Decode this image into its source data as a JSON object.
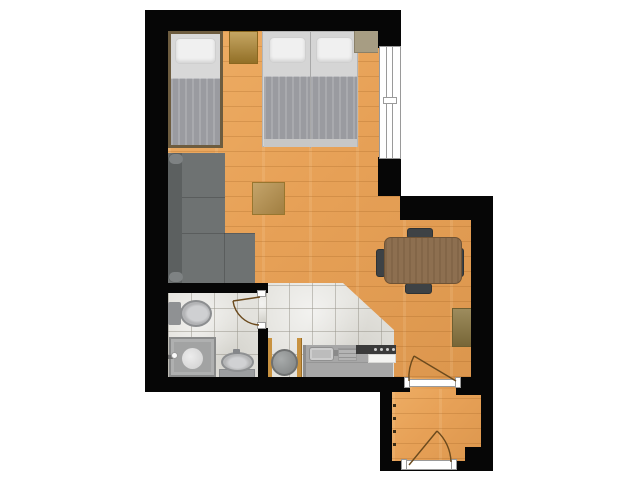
{
  "meta": {
    "type": "architectural-floor-plan",
    "visible_text": ""
  },
  "colors": {
    "wall": "#060606",
    "outside": "#ffffff",
    "floor-wood": "#e7a157",
    "floor-wood-line": "rgba(146,84,22,0.22)",
    "tile": "#e3e2dd",
    "tile-line": "rgba(150,147,137,0.5)",
    "mattress": "#d5d5d5",
    "pillow": "#f0f0f0",
    "blanket": "#9a9ba0",
    "bed-frame": "#6d5c3f",
    "nightstand": "#b2882f",
    "wardrobe": "#a79d83",
    "sofa": "#6e7272",
    "sofa-back": "#5c6060",
    "sofa-arm": "#7e8283",
    "coffee-table": "#b7904a",
    "dining-table": "#8d6f50",
    "chair": "#3e4245",
    "sideboard": "#8c7841",
    "toilet": "#b3b4b6",
    "fixture-dark": "#8f9193",
    "shower-pan": "#a2a3a3",
    "basin": "#b5b6b7",
    "washer": "#909292",
    "niche-panel": "#c89240",
    "counter": "#a7a7a7",
    "counter-sink": "#bcbcbc",
    "stove": "#3a3a3a",
    "counter-white": "#f3f3f1",
    "door-leaf": "#ffffff",
    "door-frame": "#9a9a9a",
    "door-arc": "#6b4a1d",
    "window-frame": "#9a9a9a",
    "hook": "#3a2c16"
  },
  "rooms": [
    {
      "name": "living-sleeping-room",
      "floor": "wood"
    },
    {
      "name": "dining-nook",
      "floor": "wood"
    },
    {
      "name": "bathroom",
      "floor": "tile"
    },
    {
      "name": "kitchen",
      "floor": "tile"
    },
    {
      "name": "entrance-hall",
      "floor": "wood"
    }
  ],
  "furniture_and_fixtures": [
    {
      "name": "single-bed",
      "room": "living-sleeping-room"
    },
    {
      "name": "double-bed",
      "room": "living-sleeping-room"
    },
    {
      "name": "nightstand",
      "room": "living-sleeping-room"
    },
    {
      "name": "wardrobe-shelf",
      "room": "living-sleeping-room"
    },
    {
      "name": "corner-sofa",
      "room": "living-sleeping-room"
    },
    {
      "name": "coffee-table",
      "room": "living-sleeping-room"
    },
    {
      "name": "dining-table",
      "room": "dining-nook"
    },
    {
      "name": "dining-chair",
      "count": 4,
      "room": "dining-nook"
    },
    {
      "name": "sideboard",
      "room": "dining-nook"
    },
    {
      "name": "toilet",
      "room": "bathroom"
    },
    {
      "name": "shower",
      "room": "bathroom"
    },
    {
      "name": "washbasin",
      "room": "bathroom"
    },
    {
      "name": "washing-machine",
      "room": "kitchen"
    },
    {
      "name": "kitchen-counter-with-sink",
      "room": "kitchen"
    },
    {
      "name": "cooktop",
      "room": "kitchen"
    },
    {
      "name": "coat-hooks",
      "room": "entrance-hall"
    }
  ],
  "openings": [
    {
      "name": "window",
      "location": "bedroom-right-wall"
    },
    {
      "name": "bathroom-door",
      "location": "bathroom-east"
    },
    {
      "name": "hall-door",
      "location": "between-main-room-and-hall"
    },
    {
      "name": "entrance-door",
      "location": "hall-south"
    }
  ]
}
